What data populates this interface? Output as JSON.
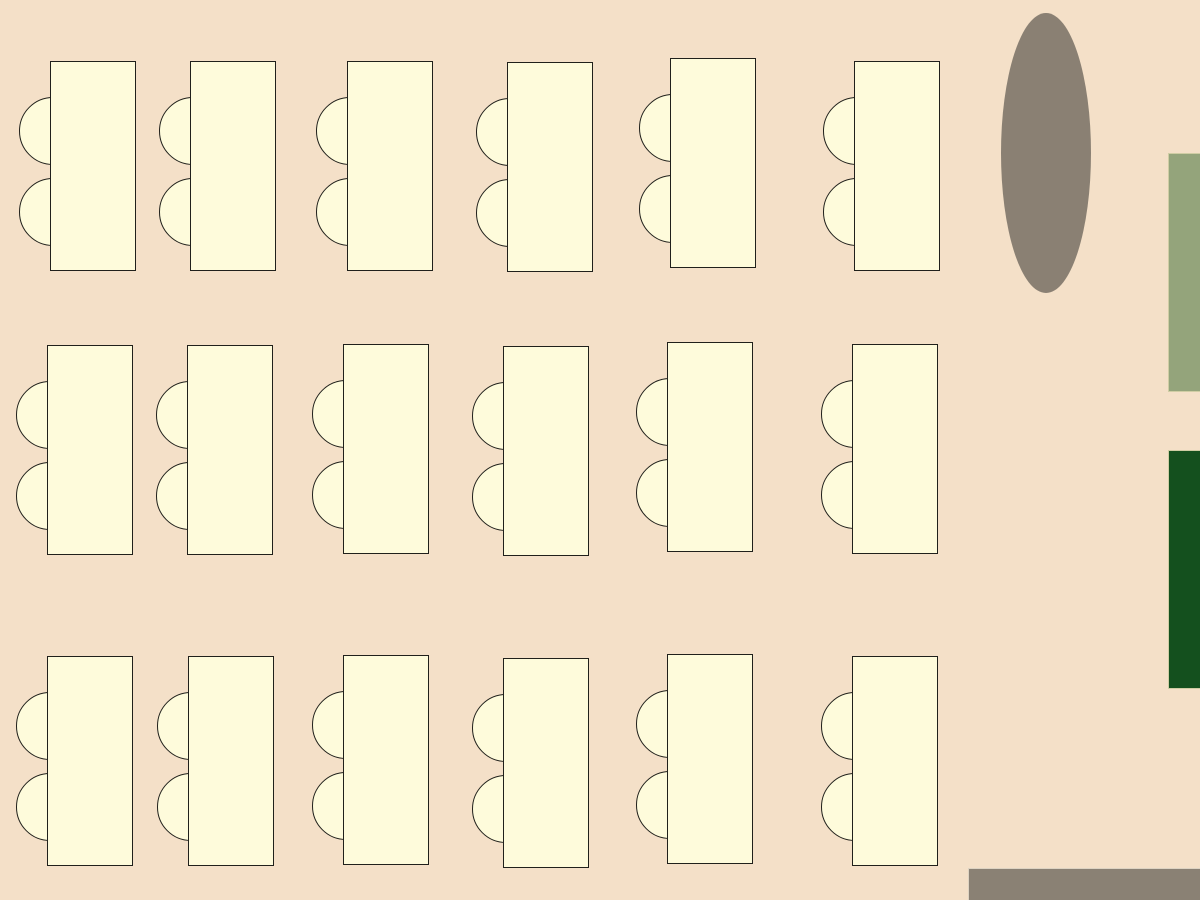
{
  "scene": {
    "name": "classroom-seating-floor-plan",
    "width": 1200,
    "height": 900,
    "desk_count": 18,
    "rows": 3,
    "desks_per_row": 6,
    "chairs_per_desk": 2
  },
  "palette": {
    "background_color": "#F4E0C8",
    "desk_fill": "#FEFBDB",
    "desk_border": "#20201B",
    "ellipse_fill": "#8A8073",
    "sage_fill": "#94A47B",
    "dark_green_fill": "#14501E",
    "gray_bar_fill": "#8A8174",
    "highlight_border": "#CFCDA4",
    "bar_highlight": "#DDD3C2"
  },
  "desk_geometry": {
    "width": 86,
    "height": 210,
    "chair_diameter": 68,
    "chair_overhang": 31,
    "chair_tops": [
      36,
      117
    ]
  },
  "desks": [
    {
      "row": 1,
      "col": 1,
      "x": 50,
      "y": 61
    },
    {
      "row": 1,
      "col": 2,
      "x": 190,
      "y": 61
    },
    {
      "row": 1,
      "col": 3,
      "x": 347,
      "y": 61
    },
    {
      "row": 1,
      "col": 4,
      "x": 507,
      "y": 62
    },
    {
      "row": 1,
      "col": 5,
      "x": 670,
      "y": 58
    },
    {
      "row": 1,
      "col": 6,
      "x": 854,
      "y": 61
    },
    {
      "row": 2,
      "col": 1,
      "x": 47,
      "y": 345
    },
    {
      "row": 2,
      "col": 2,
      "x": 187,
      "y": 345
    },
    {
      "row": 2,
      "col": 3,
      "x": 343,
      "y": 344
    },
    {
      "row": 2,
      "col": 4,
      "x": 503,
      "y": 346
    },
    {
      "row": 2,
      "col": 5,
      "x": 667,
      "y": 342
    },
    {
      "row": 2,
      "col": 6,
      "x": 852,
      "y": 344
    },
    {
      "row": 3,
      "col": 1,
      "x": 47,
      "y": 656
    },
    {
      "row": 3,
      "col": 2,
      "x": 188,
      "y": 656
    },
    {
      "row": 3,
      "col": 3,
      "x": 343,
      "y": 655
    },
    {
      "row": 3,
      "col": 4,
      "x": 503,
      "y": 658
    },
    {
      "row": 3,
      "col": 5,
      "x": 667,
      "y": 654
    },
    {
      "row": 3,
      "col": 6,
      "x": 852,
      "y": 656
    }
  ],
  "fixtures": {
    "ellipse": {
      "x": 1001,
      "y": 13,
      "width": 90,
      "height": 280
    },
    "sage_rect": {
      "x": 1168,
      "y": 153,
      "width": 32,
      "height": 239
    },
    "dark_green_rect": {
      "x": 1168,
      "y": 450,
      "width": 32,
      "height": 239
    },
    "gray_bar": {
      "x": 968,
      "y": 868,
      "width": 232,
      "height": 32
    }
  }
}
